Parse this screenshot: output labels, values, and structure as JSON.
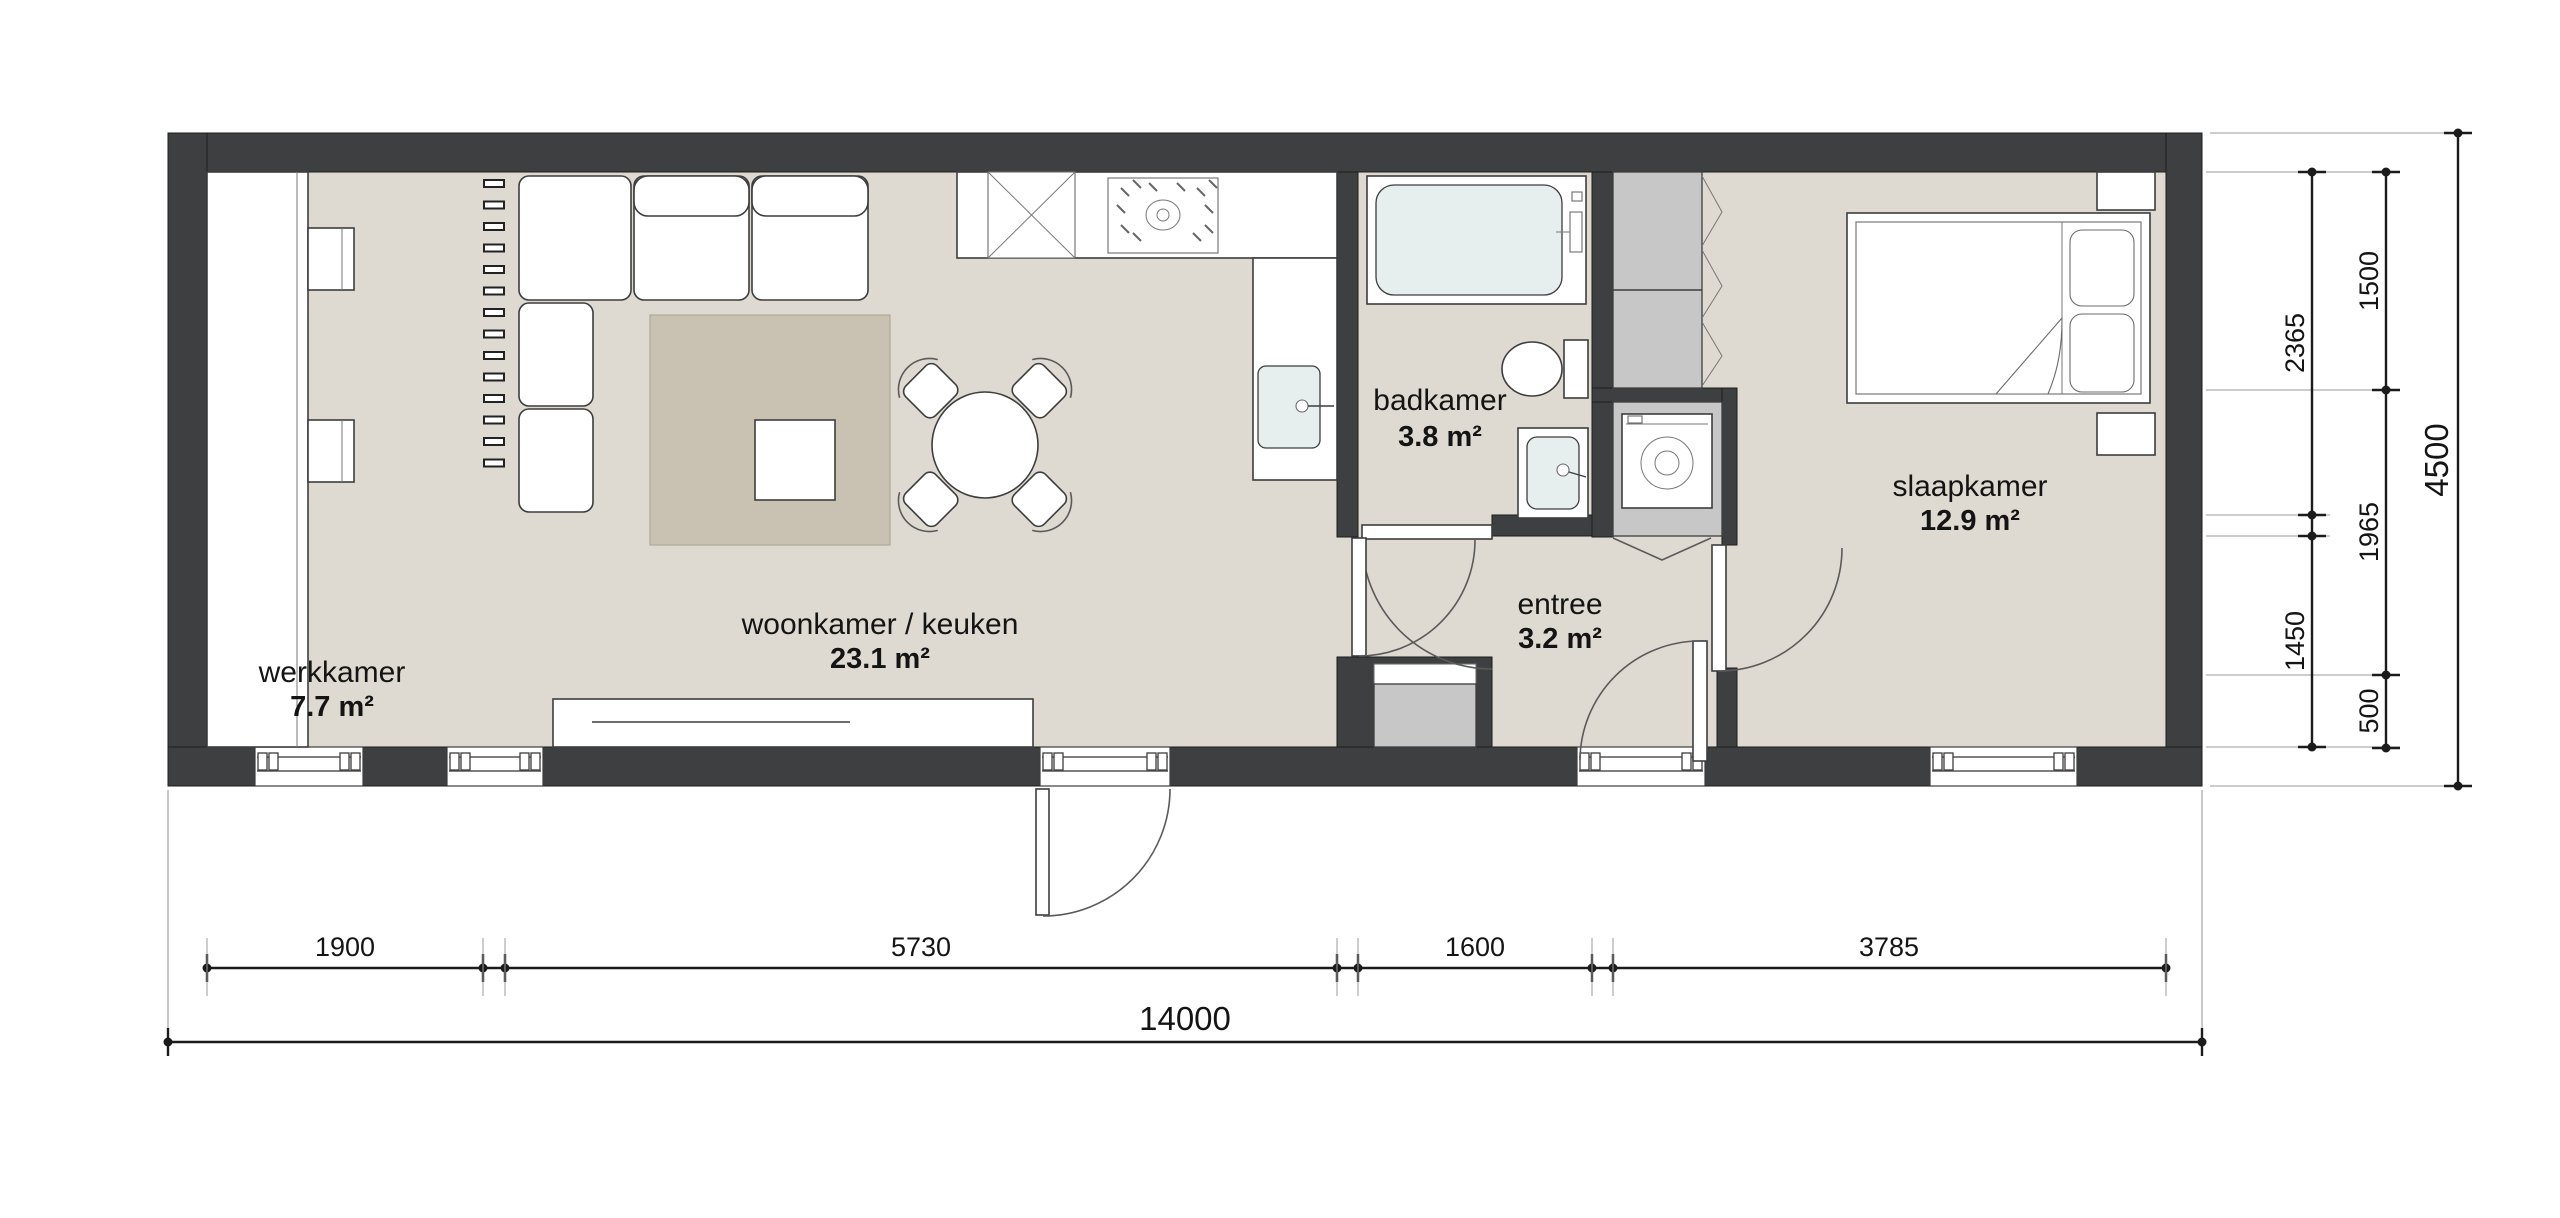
{
  "rooms": [
    {
      "id": "werkkamer",
      "name": "werkkamer",
      "area": "7.7 m²"
    },
    {
      "id": "woonkamer-keuken",
      "name": "woonkamer / keuken",
      "area": "23.1 m²"
    },
    {
      "id": "badkamer",
      "name": "badkamer",
      "area": "3.8 m²"
    },
    {
      "id": "entree",
      "name": "entree",
      "area": "3.2 m²"
    },
    {
      "id": "slaapkamer",
      "name": "slaapkamer",
      "area": "12.9 m²"
    }
  ],
  "dimensions": {
    "bottom_segments": [
      "1900",
      "5730",
      "1600",
      "3785"
    ],
    "bottom_total": "14000",
    "right_inner_segments": [
      "2365",
      "1450"
    ],
    "right_mid_segments": [
      "1500",
      "1965",
      "500"
    ],
    "right_total": "4500"
  },
  "colors": {
    "wall": "#3e3f41",
    "floor": "#dedad1",
    "rug": "#c9c2b2",
    "cabinet": "#c7c7c7",
    "fixture": "#e6eeee",
    "line": "#3d3d3d",
    "dim": "#1b1b1b",
    "ext": "#9b9b9b"
  }
}
